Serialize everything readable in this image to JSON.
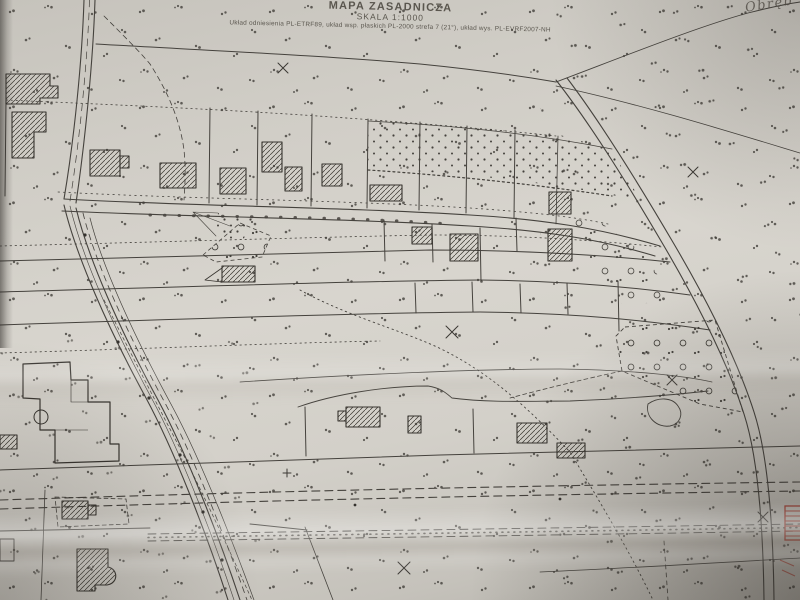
{
  "map": {
    "title": "MAPA ZASADNICZA",
    "scale": "SKALA 1:1000",
    "datum_note": "Układ odniesienia PL-ETRF89, układ wsp. płaskich PL-2000 strefa 7 (21°), układ wys. PL-EVRF2007-NH",
    "handwritten_note": "Obręb"
  },
  "colors": {
    "paper": "#d4d1ca",
    "ink": "#45423d",
    "red_annotation": "#a83f33"
  }
}
